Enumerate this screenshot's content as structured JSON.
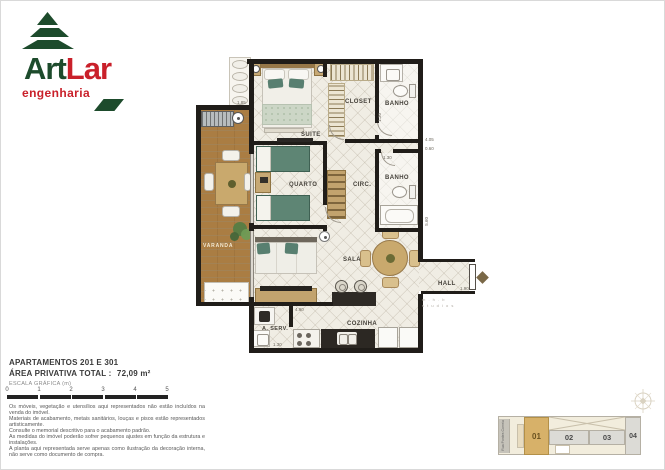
{
  "brand": {
    "name_part1": "Art",
    "name_part2": "Lar",
    "subtitle": "engenharia",
    "green": "#1d4b2c",
    "red": "#c9202a"
  },
  "plan": {
    "rooms": {
      "suite": "SUITE",
      "closet": "CLOSET",
      "banho_suite": "BANHO",
      "quarto": "QUARTO",
      "circ": "CIRC.",
      "banho_social": "BANHO",
      "sala": "SALA",
      "hall": "HALL",
      "cozinha": "COZINHA",
      "area_servico": "A. SERV.",
      "varanda": "VARANDA"
    },
    "dims": {
      "varanda_sink": "1.85",
      "banho_suite_w": "1.30",
      "circ_a": "4.05",
      "circ_b": "0.60",
      "banho_social_w": "1.30",
      "sala_h": "5.60",
      "hall_w": "1.90",
      "cozinha_w": "4.90",
      "aserv_w": "1.30"
    },
    "watermark_line1": "m . h . b",
    "watermark_line2": "s t u d i o s"
  },
  "info": {
    "title": "APARTAMENTOS 201 E 301",
    "area_label": "ÁREA PRIVATIVA TOTAL :",
    "area_value": "72,09 m²",
    "scale_label": "ESCALA GRÁFICA (m)",
    "scale_ticks": [
      "0",
      "1",
      "2",
      "3",
      "4",
      "5"
    ]
  },
  "disclaimer": {
    "lines": [
      "Os móveis, vegetação e utensílios aqui representados não estão incluídos na venda do imóvel.",
      "Materiais de acabamento, metais sanitários, louças e pisos estão representados artisticamente.",
      "Consulte o memorial descritivo para o acabamento padrão.",
      "As medidas do imóvel poderão sofrer pequenos ajustes em função da estrutura e instalações.",
      "A planta aqui representada serve apenas como ilustração da decoração interna, não serve como documento de compra."
    ]
  },
  "keyplan": {
    "street": "Rua Pontes Correia",
    "highlight_color": "#d7b169",
    "units": [
      {
        "id": "01",
        "highlighted": true
      },
      {
        "id": "02",
        "highlighted": false
      },
      {
        "id": "03",
        "highlighted": false
      },
      {
        "id": "04",
        "highlighted": false
      }
    ]
  }
}
